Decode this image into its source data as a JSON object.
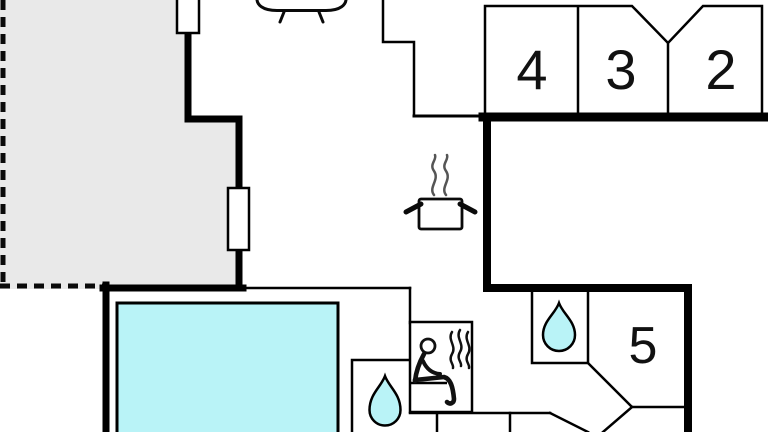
{
  "floorplan": {
    "kind": "house-floor-plan",
    "rooms": [
      {
        "id": "room-4",
        "number": "4"
      },
      {
        "id": "room-3",
        "number": "3"
      },
      {
        "id": "room-2",
        "number": "2"
      },
      {
        "id": "room-5",
        "number": "5"
      }
    ],
    "icons": [
      "sofa-icon",
      "stove-icon",
      "sauna-icon",
      "water-drop-icon",
      "water-drop-icon",
      "pool-area",
      "terrace-area"
    ],
    "colors": {
      "water": "#b9f3f7",
      "terrace": "#e9e9e9",
      "wall": "#000000",
      "background": "#ffffff"
    }
  }
}
